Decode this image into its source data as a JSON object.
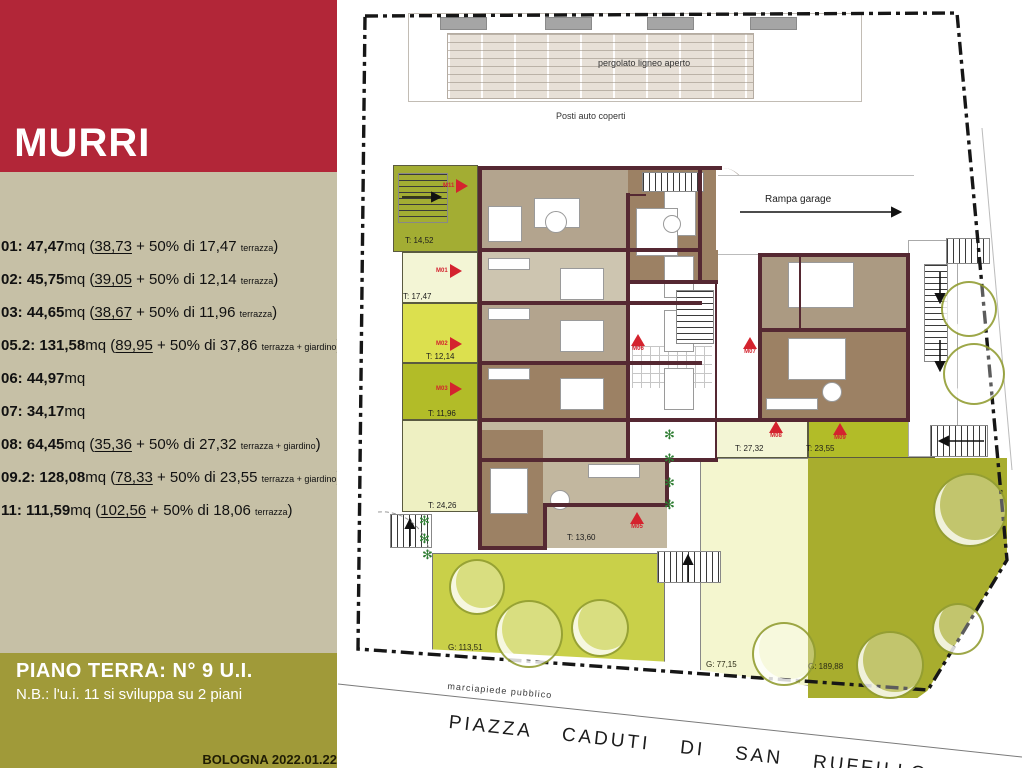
{
  "sidebar": {
    "title_prefix": "O",
    "title": "MURRI",
    "units": [
      {
        "id": "01:",
        "total": "47,47",
        "suffix": "mq",
        "base": "38,73",
        "mid": "+ 50% di",
        "extra": "17,47",
        "note": "terrazza"
      },
      {
        "id": "02:",
        "total": "45,75",
        "suffix": "mq",
        "base": "39,05",
        "mid": "+ 50% di",
        "extra": "12,14",
        "note": "terrazza"
      },
      {
        "id": "03:",
        "total": "44,65",
        "suffix": "mq",
        "base": "38,67",
        "mid": "+ 50% di",
        "extra": "11,96",
        "note": "terrazza"
      },
      {
        "id": "05.2:",
        "total": "131,58",
        "suffix": "mq",
        "base": "89,95",
        "mid": "+ 50% di",
        "extra": "37,86",
        "note": "terrazza + giardino"
      },
      {
        "id": "06:",
        "total": "44,97",
        "suffix": "mq"
      },
      {
        "id": "07:",
        "total": "34,17",
        "suffix": "mq"
      },
      {
        "id": "08:",
        "total": "64,45",
        "suffix": "mq",
        "base": "35,36",
        "mid": "+ 50% di",
        "extra": "27,32",
        "note": "terrazza + giardino"
      },
      {
        "id": "09.2:",
        "total": "128,08",
        "suffix": "mq",
        "base": "78,33",
        "mid": "+ 50% di",
        "extra": "23,55",
        "note": "terrazza + giardino"
      },
      {
        "id": "11:",
        "total": "111,59",
        "suffix": "mq",
        "base": "102,56",
        "mid": "+ 50% di",
        "extra": "18,06",
        "note": "terrazza"
      }
    ],
    "footer": {
      "line1": "PIANO TERRA: N° 9 U.I.",
      "line2": "N.B.: l'u.i. 11 si sviluppa su 2 piani",
      "stamp": "BOLOGNA 2022.01.22"
    }
  },
  "plan": {
    "top_labels": [
      {
        "text": "pergolato ligneo aperto",
        "x": 598,
        "y": 58
      },
      {
        "text": "Posti auto coperti",
        "x": 556,
        "y": 111
      }
    ],
    "ramp_label": {
      "text": "Rampa garage",
      "x": 765,
      "y": 194
    },
    "street_labels": {
      "sidewalk": {
        "text": "marciapiede pubblico",
        "x": 448,
        "y": 681
      },
      "piazza": {
        "text": "PIAZZA  CADUTI  DI  SAN  RUFFILLO",
        "x": 450,
        "y": 712
      }
    },
    "area_labels": [
      {
        "text": "T: 14,52",
        "x": 405,
        "y": 236
      },
      {
        "text": "T: 17,47",
        "x": 403,
        "y": 292
      },
      {
        "text": "T: 12,14",
        "x": 426,
        "y": 352
      },
      {
        "text": "T: 11,96",
        "x": 428,
        "y": 409
      },
      {
        "text": "T: 24,26",
        "x": 428,
        "y": 501
      },
      {
        "text": "T: 13,60",
        "x": 567,
        "y": 533
      },
      {
        "text": "T: 27,32",
        "x": 735,
        "y": 444
      },
      {
        "text": "T: 23,55",
        "x": 806,
        "y": 444
      },
      {
        "text": "G: 113,51",
        "x": 448,
        "y": 643
      },
      {
        "text": "G: 77,15",
        "x": 706,
        "y": 660
      },
      {
        "text": "G: 189,88",
        "x": 808,
        "y": 662
      }
    ],
    "markers": [
      {
        "label": "M11",
        "x": 463,
        "y": 186,
        "dir": "right"
      },
      {
        "label": "M01",
        "x": 456,
        "y": 271,
        "dir": "right"
      },
      {
        "label": "M02",
        "x": 456,
        "y": 344,
        "dir": "right"
      },
      {
        "label": "M03",
        "x": 456,
        "y": 389,
        "dir": "right"
      },
      {
        "label": "M06",
        "x": 638,
        "y": 334,
        "dir": "up"
      },
      {
        "label": "M07",
        "x": 750,
        "y": 337,
        "dir": "up"
      },
      {
        "label": "M05",
        "x": 637,
        "y": 512,
        "dir": "up"
      },
      {
        "label": "M08",
        "x": 776,
        "y": 421,
        "dir": "up"
      },
      {
        "label": "M09",
        "x": 840,
        "y": 423,
        "dir": "up"
      }
    ],
    "trees": [
      {
        "cx": 475,
        "cy": 585,
        "r": 26
      },
      {
        "cx": 527,
        "cy": 632,
        "r": 32
      },
      {
        "cx": 598,
        "cy": 626,
        "r": 27
      },
      {
        "cx": 782,
        "cy": 652,
        "r": 30
      },
      {
        "cx": 968,
        "cy": 508,
        "r": 35
      },
      {
        "cx": 956,
        "cy": 627,
        "r": 24
      },
      {
        "cx": 888,
        "cy": 663,
        "r": 32
      },
      {
        "cx": 967,
        "cy": 307,
        "r": 26
      },
      {
        "cx": 972,
        "cy": 372,
        "r": 29
      }
    ],
    "plants": [
      {
        "x": 664,
        "y": 428
      },
      {
        "x": 664,
        "y": 452
      },
      {
        "x": 664,
        "y": 476
      },
      {
        "x": 664,
        "y": 498
      },
      {
        "x": 419,
        "y": 514
      },
      {
        "x": 419,
        "y": 532
      },
      {
        "x": 422,
        "y": 548
      }
    ]
  },
  "colors": {
    "red": "#b22638",
    "beige": "#c6c0a6",
    "olive": "#a09a39",
    "marker": "#d4232e",
    "garden_mid": "#c9d049",
    "garden_cream": "#f4f6cf",
    "garden_dark": "#a8ad2e",
    "terr_olive": "#a3ad33",
    "terr_pale": "#f3f5d5",
    "terr_bright": "#dce04e",
    "terr_dark": "#b2bc28",
    "terr_soft": "#eef0c2"
  }
}
